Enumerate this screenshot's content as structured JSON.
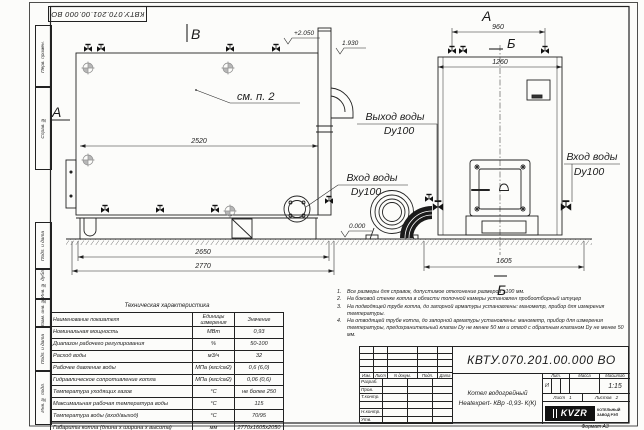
{
  "sheet": {
    "code_stamp": "КВТУ.070.201.00.000  ВО",
    "format_note": "Формат   А3"
  },
  "margin": {
    "labels": [
      "Перв. примен.",
      "Справ. №",
      "Подп. и дата",
      "Инв. № дубл.",
      "Взам. инв. №",
      "Подп. и дата",
      "Инв. № подл."
    ]
  },
  "drawing": {
    "sections": {
      "v_top": "В",
      "a_left": "А",
      "a_top": "А",
      "b_top": "Б",
      "b_bottom": "Б"
    },
    "labels": {
      "see_item": "см. п. 2",
      "water_out_1": "Выход воды",
      "water_out_2": "Dy100",
      "water_in_left_1": "Вход воды",
      "water_in_left_2": "Dy100",
      "water_in_right_1": "Вход воды",
      "water_in_right_2": "Dy100"
    },
    "elevations": {
      "top": "+2.050",
      "flue": "1.930",
      "zero": "0.000"
    },
    "dims": {
      "len_body": "2520",
      "len_base": "2650",
      "len_total": "2770",
      "front_top": "960",
      "front_width": "1260",
      "front_base": "1605"
    }
  },
  "tech_table": {
    "title": "Техническая характеристика",
    "headers": [
      "Наименование показателя",
      "Единицы измерения",
      "Значение"
    ],
    "rows": [
      [
        "Номинальная мощность",
        "МВт",
        "0,93"
      ],
      [
        "Диапазон рабочего регулирования",
        "%",
        "50-100"
      ],
      [
        "Расход воды",
        "м3/ч",
        "32"
      ],
      [
        "Рабочее давление воды",
        "МПа (кгс/см2)",
        "0,6 (6,0)"
      ],
      [
        "Гидравлическое сопротивление котла",
        "МПа (кгс/см2)",
        "0,06 (0,6)"
      ],
      [
        "Температура уходящих газов",
        "°С",
        "не более 250"
      ],
      [
        "Максимальная рабочая температура воды",
        "°С",
        "115"
      ],
      [
        "Температура воды (вход/выход)",
        "°С",
        "70/95"
      ],
      [
        "Габариты котла (длина х ширина х высота)",
        "мм",
        "2770х1605х2050"
      ]
    ]
  },
  "notes": {
    "items": [
      {
        "n": "1.",
        "text": "Все размеры для справок, допустимое отклонение размеров ±100 мм."
      },
      {
        "n": "2.",
        "text": "На боковой стенке котла в области топочной камеры установлен пробоотборный штуцер"
      },
      {
        "n": "3.",
        "text": "На подводящей трубе котла, до запорной арматуры установлены: манометр, прибор для измерения температуры."
      },
      {
        "n": "4.",
        "text": "На отводящей трубе котла, до запорной арматуры установлены: манометр, прибор для измерения температуры, предохранительный клапан Dу не менее 50 мм и отвод с обратным клапаном Dу не менее 50 мм."
      }
    ]
  },
  "title_block": {
    "doc_number": "КВТУ.070.201.00.000  ВО",
    "product_name_1": "Котел водогрейный",
    "product_name_2": "Heatexpert- КВр -0,93- К(К)",
    "rev_header": [
      "Изм.",
      "Лист",
      "N докум.",
      "Подп.",
      "Дата"
    ],
    "roles": [
      "Разраб.",
      "Пров.",
      "Т.контр.",
      "",
      "Н.контр.",
      "Утв."
    ],
    "lit_label": "Лит.",
    "mass_label": "Масса",
    "scale_label": "Масштаб",
    "lit_value": "И",
    "scale_value": "1:15",
    "sheet_label": "Лист",
    "sheet_value": "1",
    "sheets_label": "Листов",
    "sheets_value": "2",
    "logo_text": "KVZR",
    "logo_caption_1": "КОТЕЛЬНЫЙ",
    "logo_caption_2": "ЗАВОД РЭП"
  }
}
